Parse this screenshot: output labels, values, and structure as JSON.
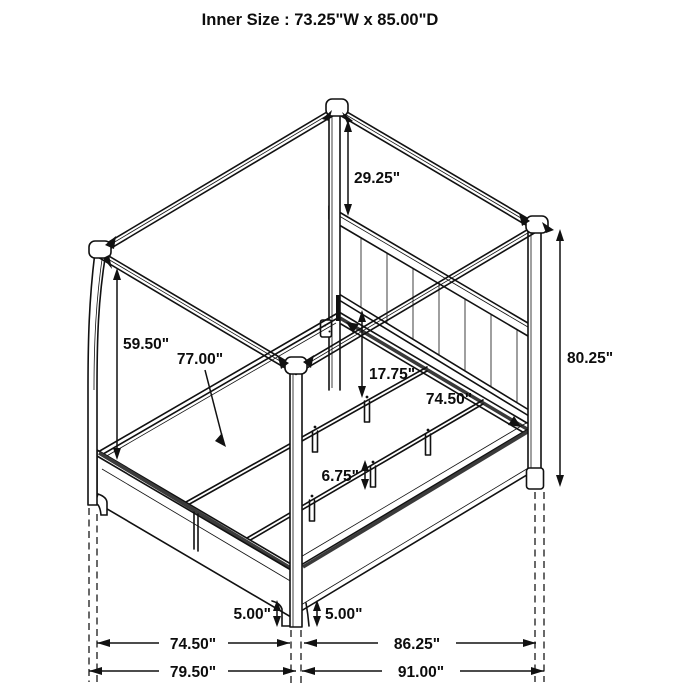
{
  "header": {
    "title": "Inner Size : 73.25\"W x 85.00\"D"
  },
  "diagram": {
    "subject": "isometric dimension drawing of a four-poster canopy storage bed",
    "line_color": "#111111",
    "background": "#ffffff",
    "labels": {
      "canopy_to_headboard": "29.25\"",
      "rail_to_canopy": "59.50\"",
      "support_rail_length": "77.00\"",
      "headboard_to_slat": "17.75\"",
      "slat_length": "74.50\"",
      "total_height": "80.25\"",
      "leg_height": "6.75\"",
      "left_clearance": "5.00\"",
      "right_clearance": "5.00\"",
      "front_inner_width": "74.50\"",
      "side_inner_length": "86.25\"",
      "front_outer_width": "79.50\"",
      "side_outer_length": "91.00\""
    }
  }
}
